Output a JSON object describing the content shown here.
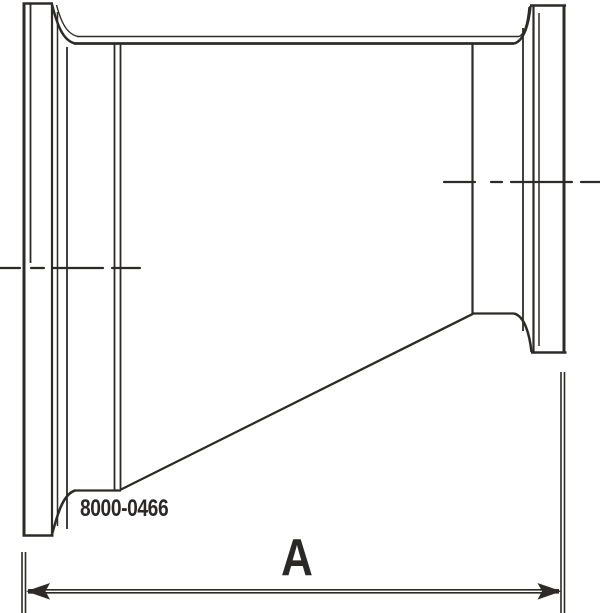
{
  "page": {
    "background_color": "#ffffff"
  },
  "drawing": {
    "kind": "technical-line-drawing",
    "subject": "eccentric-reducer-with-clamp-ends-side-view",
    "line_color": "#2d2b28",
    "text_color": "#2b2927",
    "part_number": "8000-0466",
    "dimension": {
      "label": "A"
    }
  }
}
